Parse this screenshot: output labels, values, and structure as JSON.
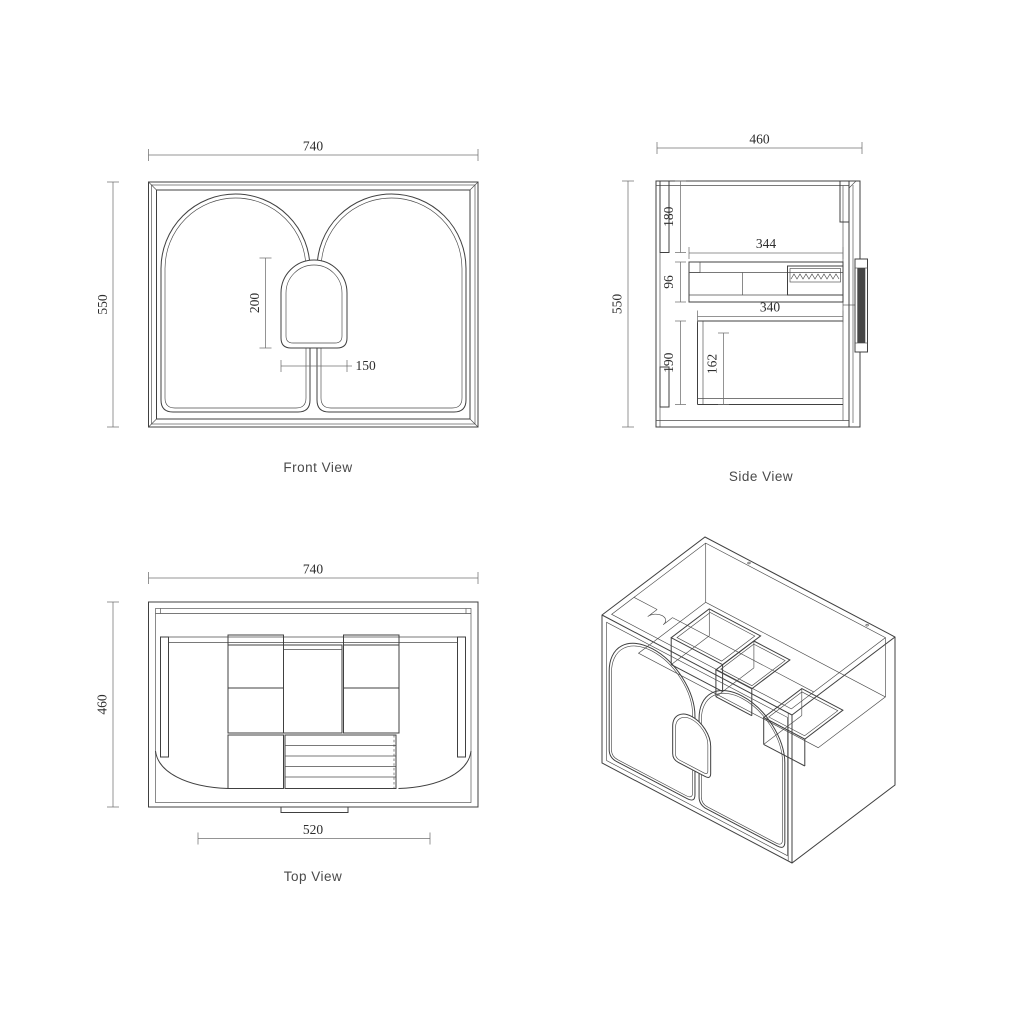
{
  "page": {
    "background": "#ffffff"
  },
  "colors": {
    "line": "#404040",
    "dim_line": "#707070",
    "dim_text": "#2e2e2e",
    "label_text": "#4a4a4a"
  },
  "views": {
    "front": {
      "label": "Front View",
      "dim_width": "740",
      "dim_height": "550",
      "dim_handle_height": "200",
      "dim_handle_width": "150"
    },
    "side": {
      "label": "Side View",
      "dim_width": "460",
      "dim_height": "550",
      "dim_top": "180",
      "dim_drawer_len": "344",
      "dim_drawer_h": "96",
      "dim_shelf_len": "340",
      "dim_lower_h": "190",
      "dim_inner_h": "162"
    },
    "top": {
      "label": "Top View",
      "dim_width": "740",
      "dim_depth": "460",
      "dim_opening": "520"
    }
  }
}
